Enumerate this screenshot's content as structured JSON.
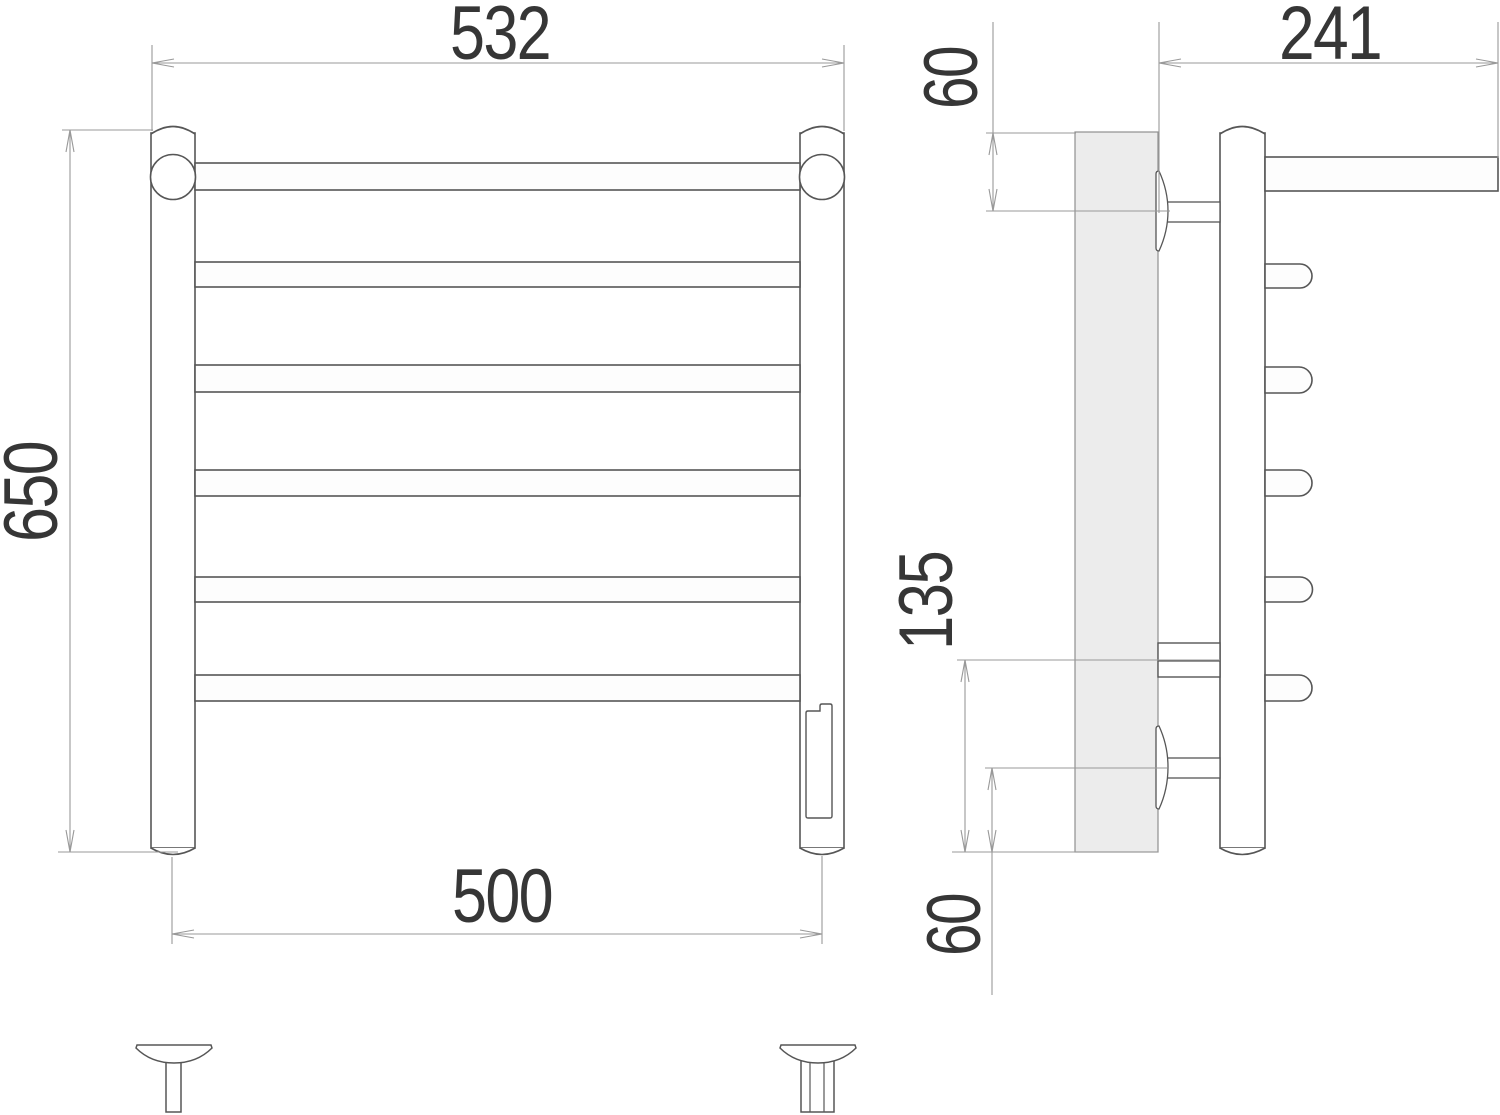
{
  "dimensions": {
    "front_overall_width": "532",
    "front_height": "650",
    "front_pipe_center_width": "500",
    "side_depth": "241",
    "side_top_offset": "60",
    "side_lower_span": "135",
    "side_bottom_offset": "60"
  },
  "colors": {
    "object_line": "#565656",
    "dim_line": "#999999",
    "text": "#363636",
    "plate_fill": "#ececec",
    "white_fill": "#fdfdfd"
  }
}
